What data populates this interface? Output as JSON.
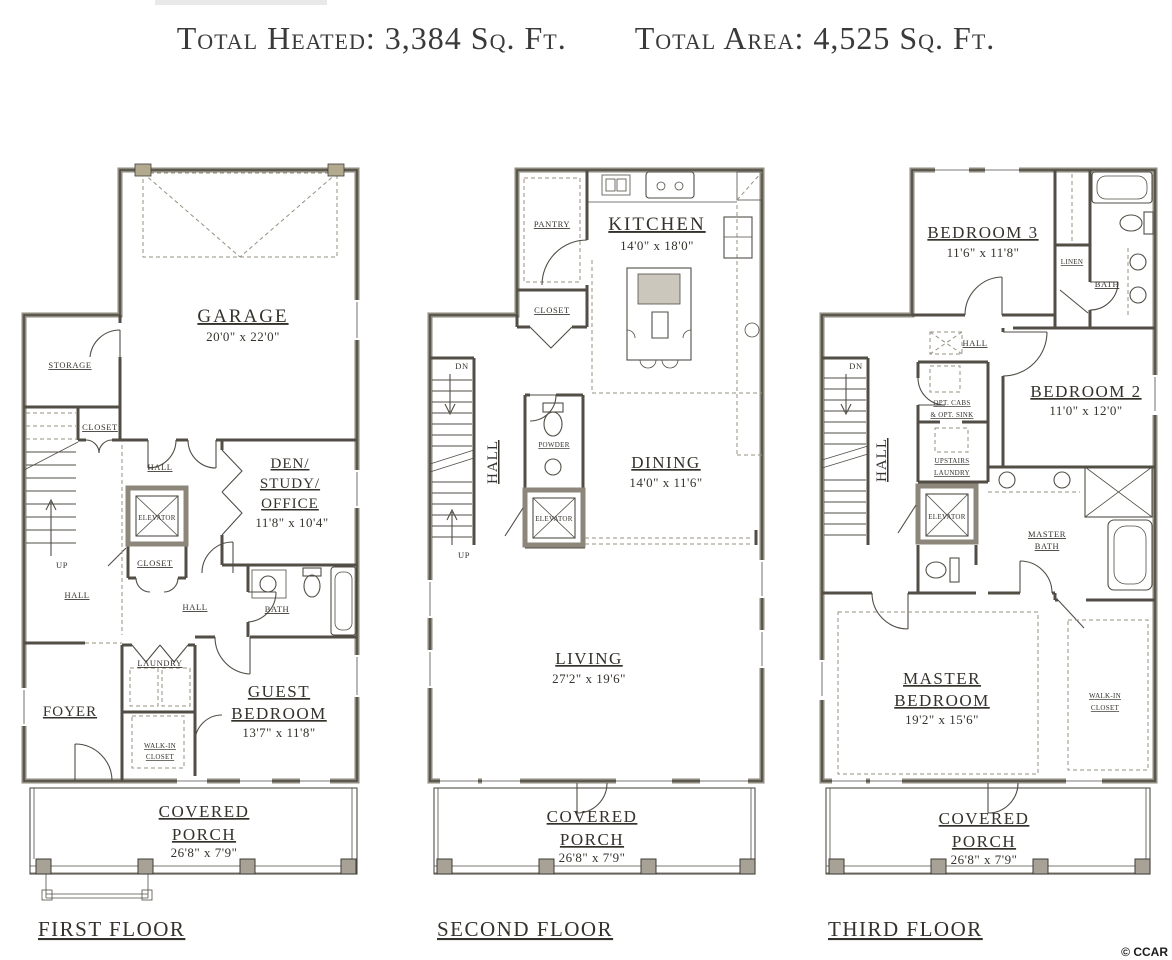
{
  "header": {
    "heated": "Total Heated: 3,384 Sq. Ft.",
    "area": "Total Area: 4,525 Sq. Ft."
  },
  "floor1": {
    "label": "FIRST FLOOR",
    "garage": {
      "name": "GARAGE",
      "dims": "20'0\" x 22'0\""
    },
    "storage": "STORAGE",
    "closet_top": "CLOSET",
    "hall_top": "HALL",
    "elevator": "ELEVATOR",
    "den_line1": "DEN/",
    "den_line2": "STUDY/",
    "den_line3": "OFFICE",
    "den_dims": "11'8\" x 10'4\"",
    "closet_mid": "CLOSET",
    "up": "UP",
    "hall_left": "HALL",
    "hall_mid": "HALL",
    "bath": "BATH",
    "laundry": "LAUNDRY",
    "foyer": "FOYER",
    "walkin_line1": "WALK-IN",
    "walkin_line2": "CLOSET",
    "guest_line1": "GUEST",
    "guest_line2": "BEDROOM",
    "guest_dims": "13'7\" x 11'8\"",
    "porch_line1": "COVERED",
    "porch_line2": "PORCH",
    "porch_dims": "26'8\" x 7'9\""
  },
  "floor2": {
    "label": "SECOND FLOOR",
    "pantry": "PANTRY",
    "kitchen": {
      "name": "KITCHEN",
      "dims": "14'0\" x 18'0\""
    },
    "closet": "CLOSET",
    "dn": "DN",
    "up": "UP",
    "hall": "HALL",
    "powder": "POWDER",
    "elevator": "ELEVATOR",
    "dining": {
      "name": "DINING",
      "dims": "14'0\" x 11'6\""
    },
    "living": {
      "name": "LIVING",
      "dims": "27'2\" x 19'6\""
    },
    "porch_line1": "COVERED",
    "porch_line2": "PORCH",
    "porch_dims": "26'8\" x 7'9\""
  },
  "floor3": {
    "label": "THIRD FLOOR",
    "bedroom3": {
      "name": "BEDROOM 3",
      "dims": "11'6\" x 11'8\""
    },
    "linen": "LINEN",
    "bath": "BATH",
    "hall_top": "HALL",
    "dn": "DN",
    "optcabs_line1": "OPT. CABS",
    "optcabs_line2": "& OPT. SINK",
    "bedroom2": {
      "name": "BEDROOM 2",
      "dims": "11'0\" x 12'0\""
    },
    "hall_left": "HALL",
    "laundry_line1": "UPSTAIRS",
    "laundry_line2": "LAUNDRY",
    "elevator": "ELEVATOR",
    "masterbath_line1": "MASTER",
    "masterbath_line2": "BATH",
    "master_line1": "MASTER",
    "master_line2": "BEDROOM",
    "master_dims": "19'2\" x 15'6\"",
    "walkin_line1": "WALK-IN",
    "walkin_line2": "CLOSET",
    "porch_line1": "COVERED",
    "porch_line2": "PORCH",
    "porch_dims": "26'8\" x 7'9\""
  },
  "footer": {
    "copyright": "© CCAR"
  }
}
